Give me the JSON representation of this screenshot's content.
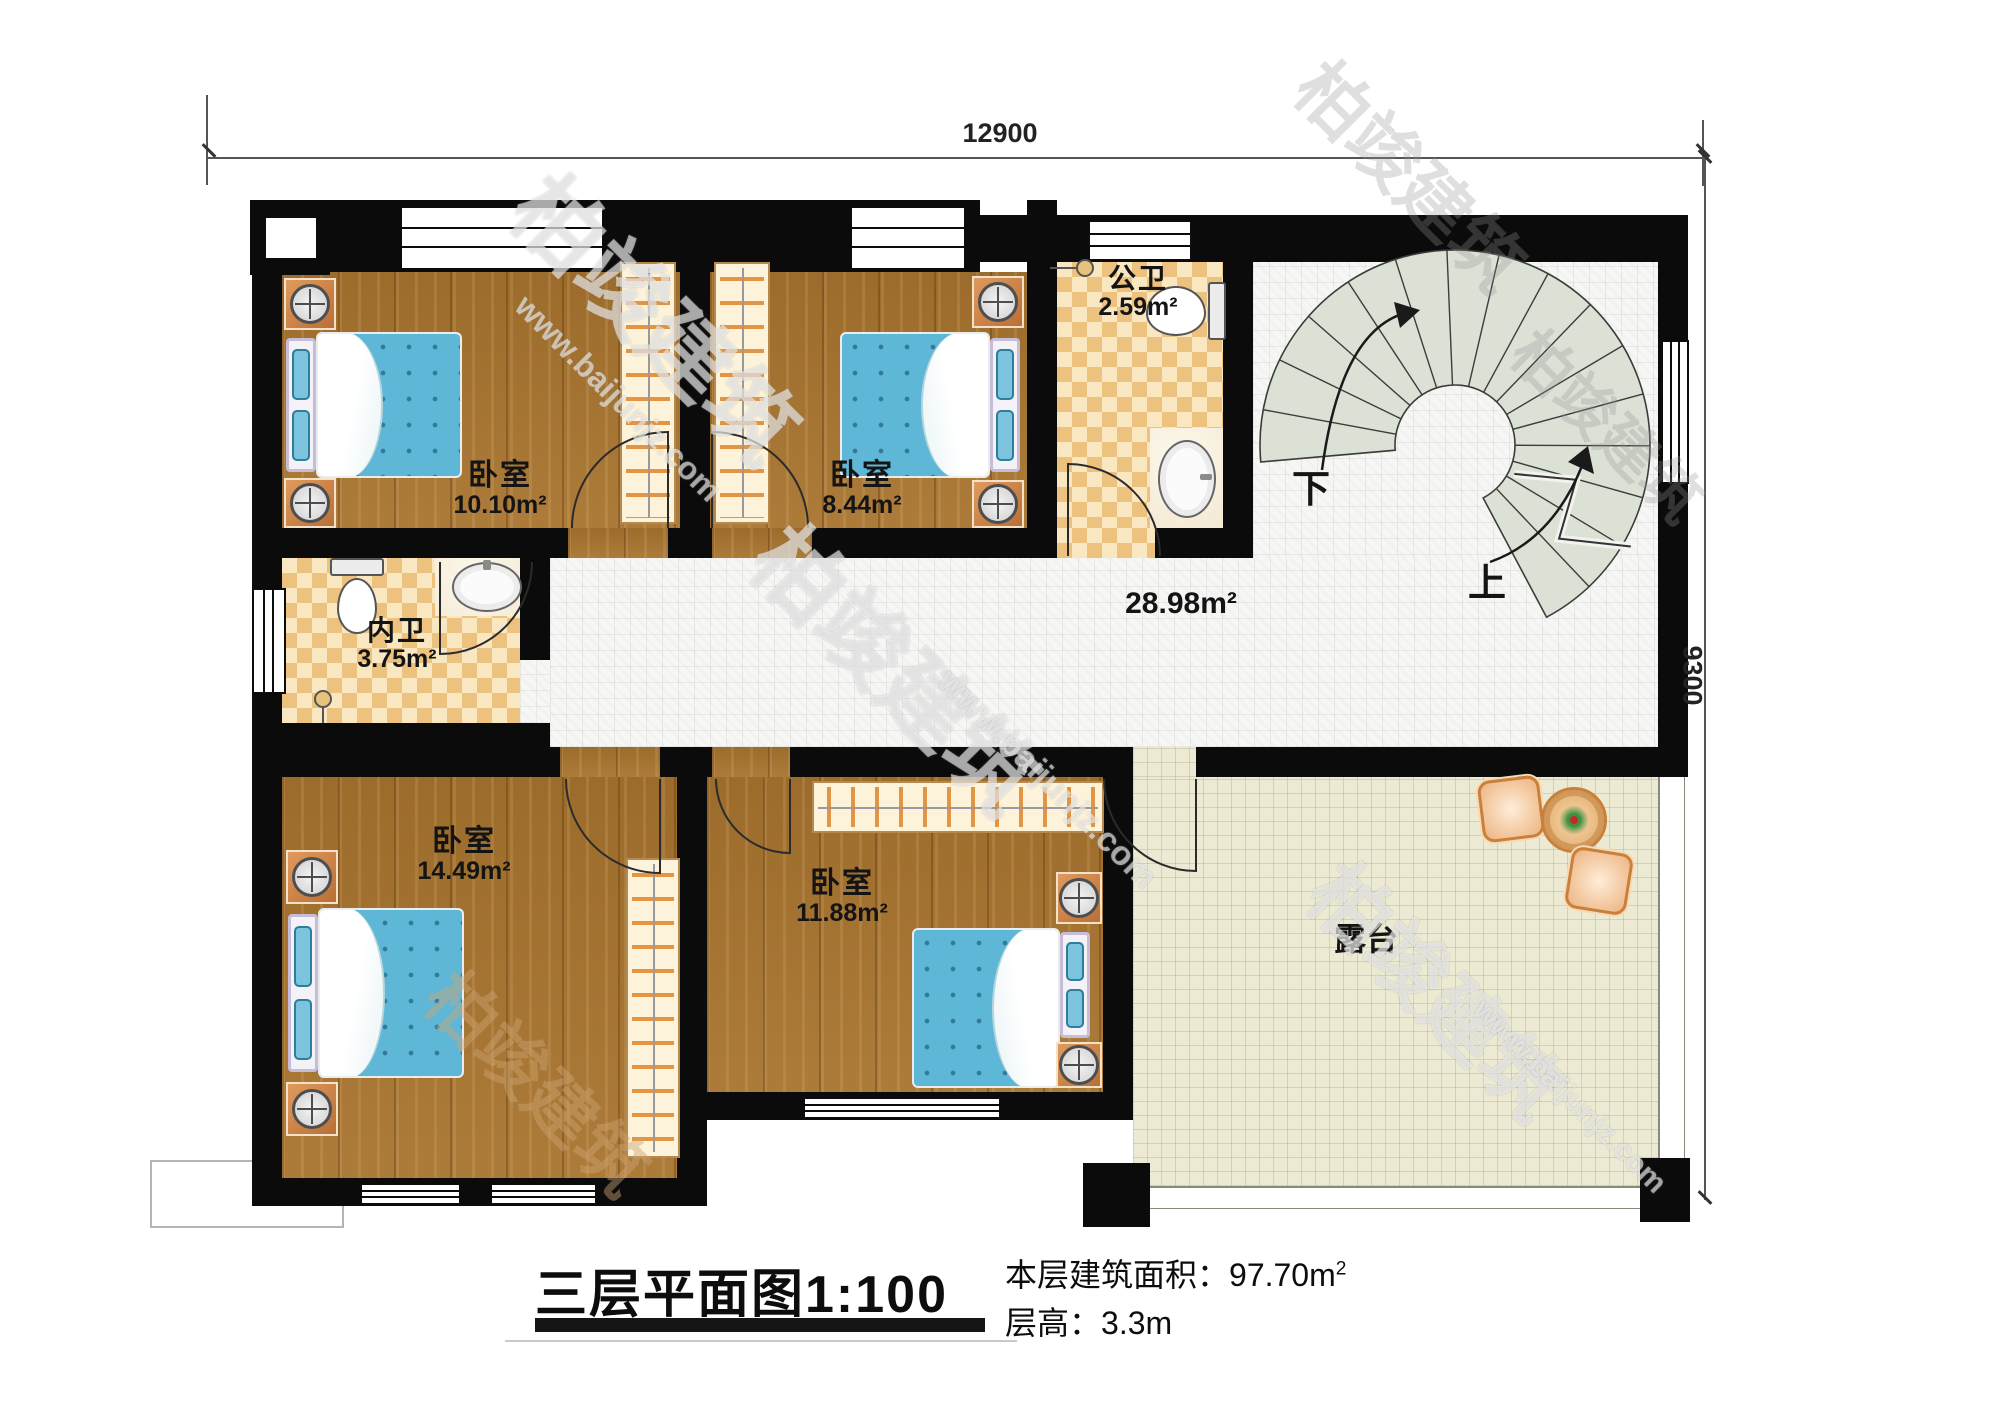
{
  "watermark": {
    "brand": "柏竣建筑",
    "url": "www.baijunjz.com"
  },
  "dimensions": {
    "width": "12900",
    "height": "9300"
  },
  "rooms": {
    "bedroom1": {
      "name": "卧室",
      "area": "10.10m²"
    },
    "bedroom2": {
      "name": "卧室",
      "area": "8.44m²"
    },
    "public_bath": {
      "name": "公卫",
      "area": "2.59m²"
    },
    "inner_bath": {
      "name": "内卫",
      "area": "3.75m²"
    },
    "hallway": {
      "area": "28.98m²"
    },
    "bedroom3": {
      "name": "卧室",
      "area": "14.49m²"
    },
    "bedroom4": {
      "name": "卧室",
      "area": "11.88m²"
    },
    "terrace": {
      "name": "露台"
    }
  },
  "stairs": {
    "down": "下",
    "up": "上"
  },
  "titleblock": {
    "title": "三层平面图",
    "scale": "1:100",
    "floor_area_label": "本层建筑面积：",
    "floor_area": "97.70m",
    "floor_area_sup": "2",
    "floor_height_label": "层高：",
    "floor_height": "3.3m"
  },
  "colors": {
    "wall": "#0b0b0b",
    "wood": "#a8742f",
    "bed": "#5fb7d8",
    "checker": "#ecc27e",
    "tile": "#f6f6f4",
    "terrace": "#ecead3",
    "stair": "#dce1d6"
  }
}
